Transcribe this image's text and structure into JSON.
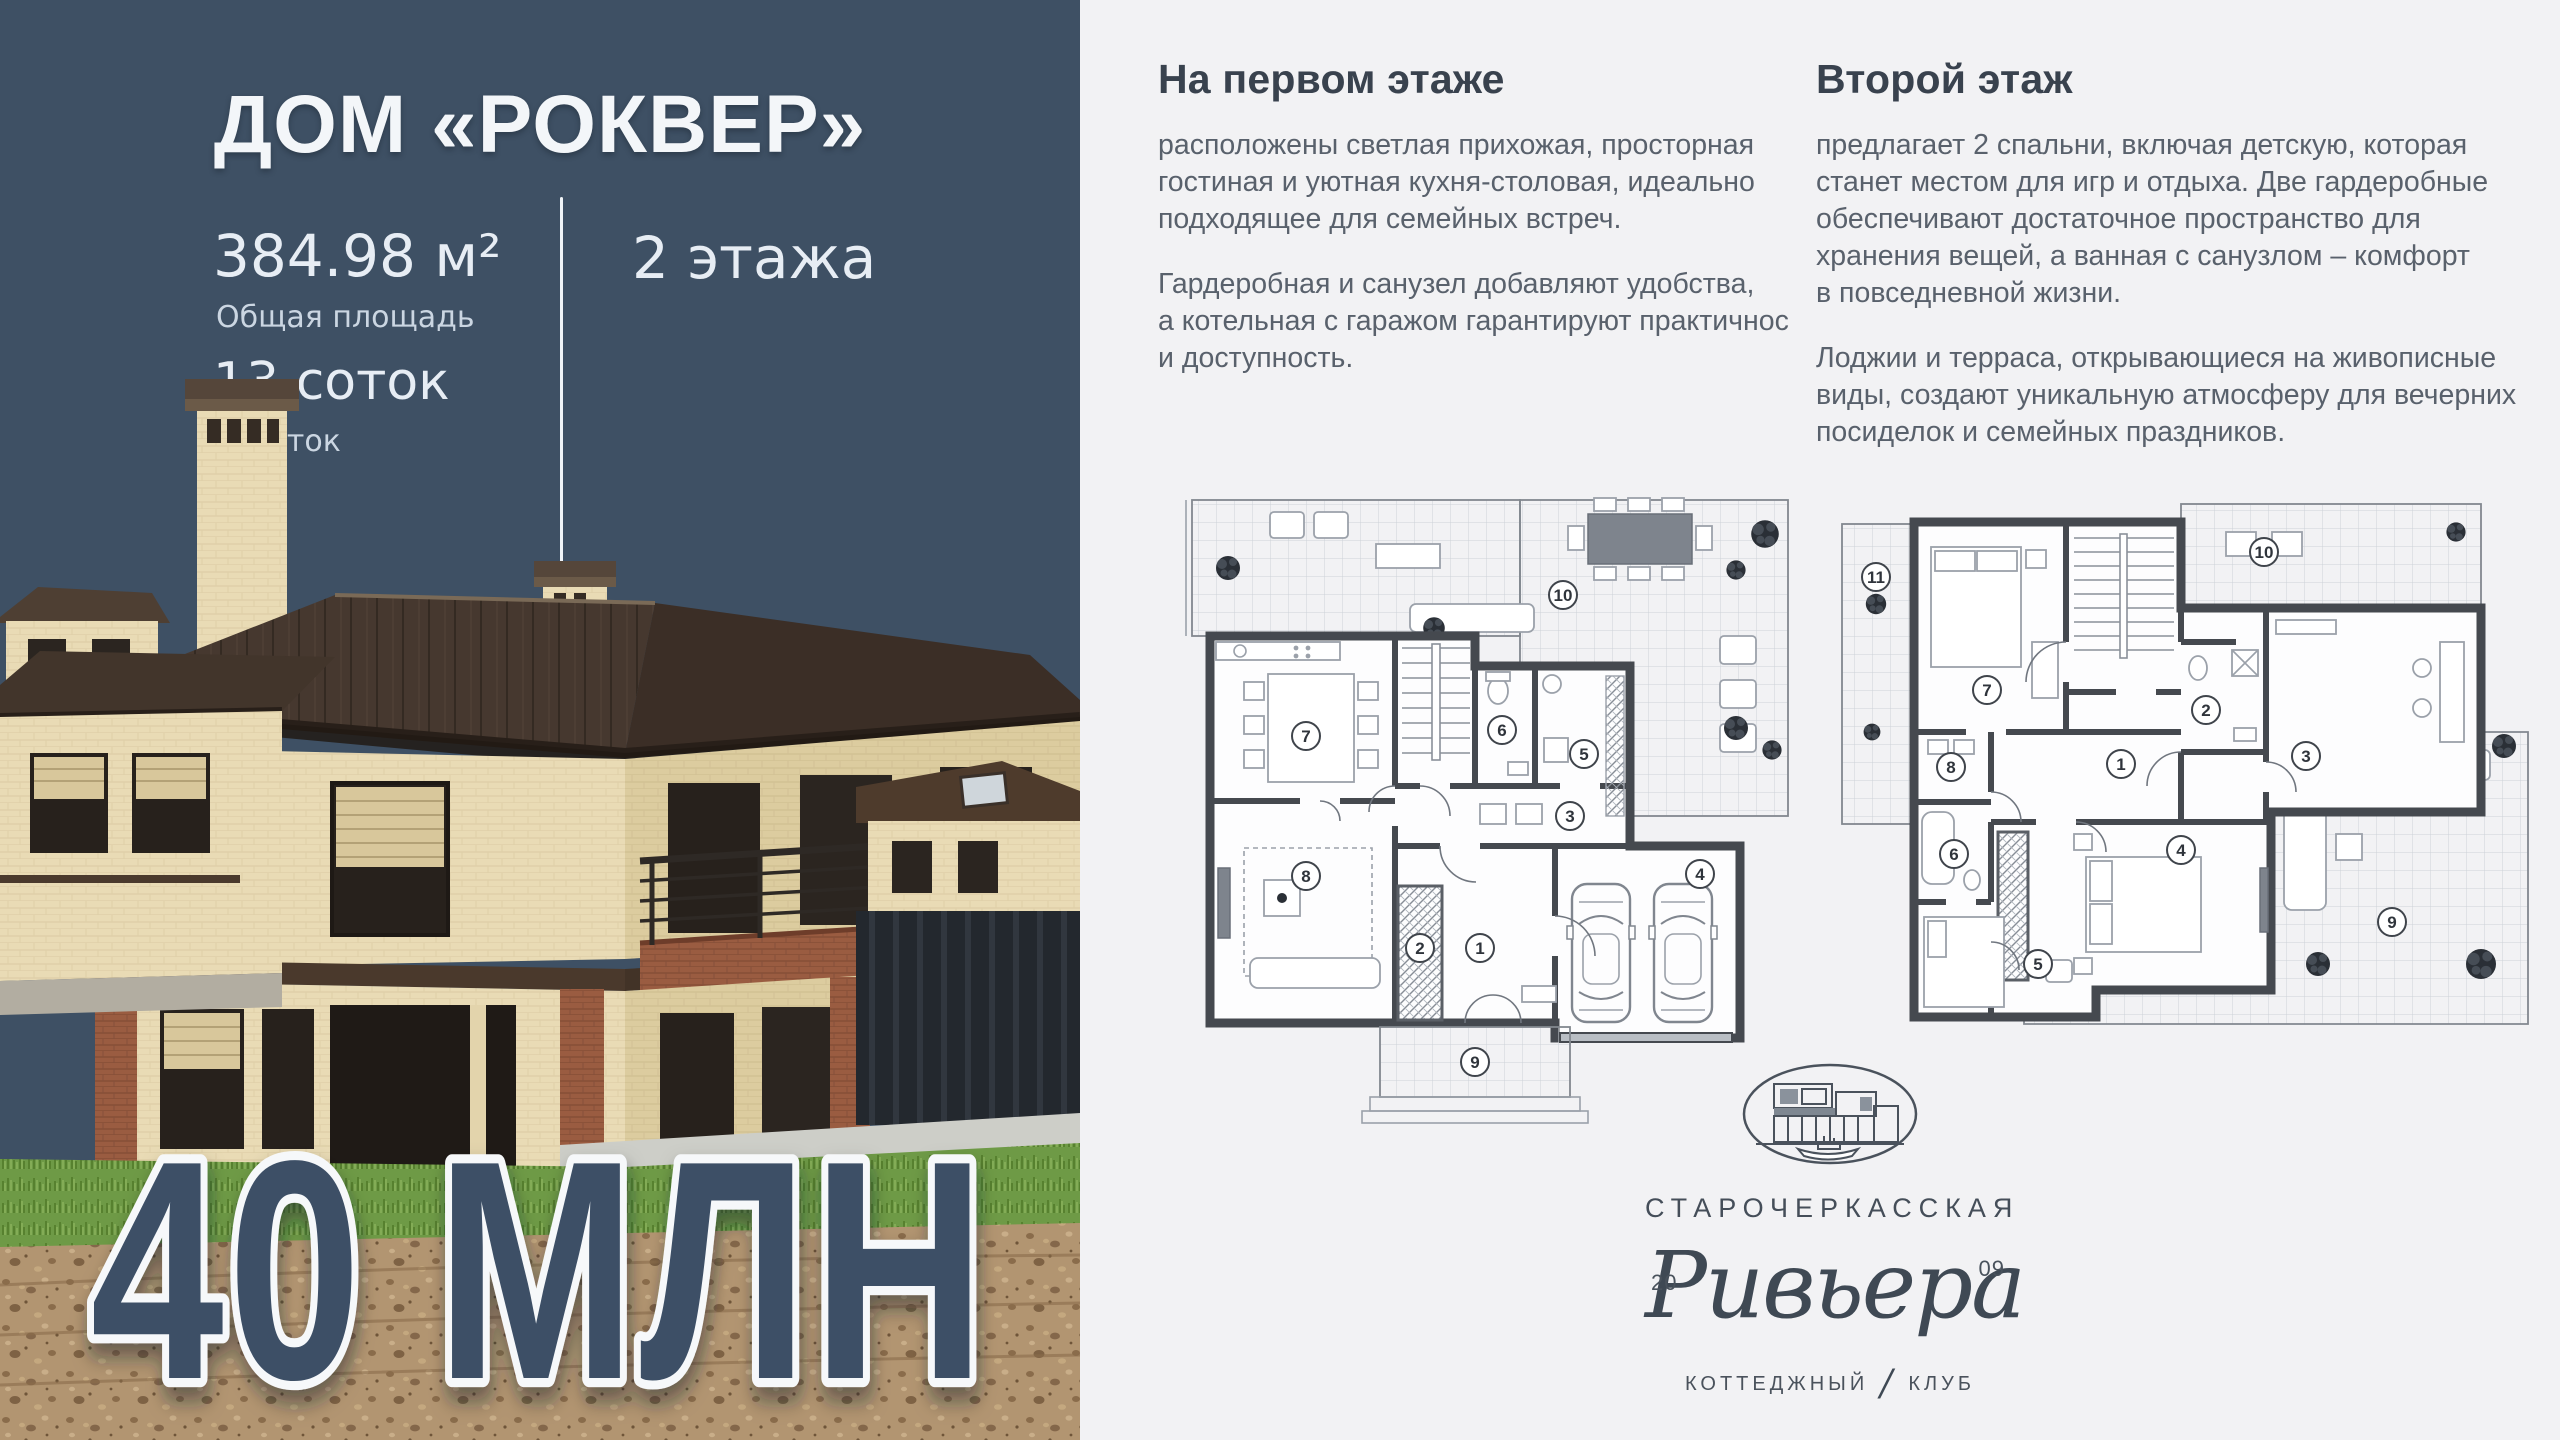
{
  "left_panel": {
    "title": "ДОМ «РОКВЕР»",
    "area": {
      "value": "384.98 м²",
      "label": "Общая площадь"
    },
    "plot": {
      "value": "13 соток",
      "label": "Участок"
    },
    "floors": "2 этажа",
    "price": "40 МЛН"
  },
  "right_panel": {
    "first_floor": {
      "heading": "На первом этаже",
      "paragraph1": "расположены светлая прихожая, просторная\nгостиная и уютная кухня-столовая, идеально\nподходящее для семейных встреч.",
      "paragraph2": "Гардеробная и санузел добавляют удобства,\nа котельная с гаражом гарантируют практичнос\nи доступность."
    },
    "second_floor": {
      "heading": "Второй этаж",
      "paragraph1": "предлагает 2 спальни, включая детскую, которая\nстанет местом для игр и отдыха. Две гардеробные\nобеспечивают достаточное пространство для\nхранения вещей, а ванная с санузлом – комфорт\nв повседневной жизни.",
      "paragraph2": "Лоджии и терраса, открывающиеся на живописные\nвиды, создают уникальную атмосферу для вечерних\nпосиделок и семейных праздников."
    },
    "floor_plan_1_rooms": [
      "1",
      "2",
      "3",
      "4",
      "5",
      "6",
      "7",
      "8",
      "9",
      "10"
    ],
    "floor_plan_2_rooms": [
      "1",
      "2",
      "3",
      "4",
      "5",
      "6",
      "7",
      "8",
      "9",
      "10",
      "11"
    ]
  },
  "logo": {
    "location": "СТАРОЧЕРКАССКАЯ",
    "name": "Ривьера",
    "year_left": "20",
    "year_right": "09",
    "club_left": "КОТТЕДЖНЫЙ",
    "slash": "/",
    "club_right": "КЛУБ"
  },
  "colors": {
    "panel_bg": "#3E5064",
    "page_bg": "#F2F2F4",
    "price_fill": "#3C4F66",
    "price_outline": "#F6F8FA",
    "heading_text": "#39424E",
    "body_text": "#59616C",
    "plan_wall": "#45494F"
  }
}
